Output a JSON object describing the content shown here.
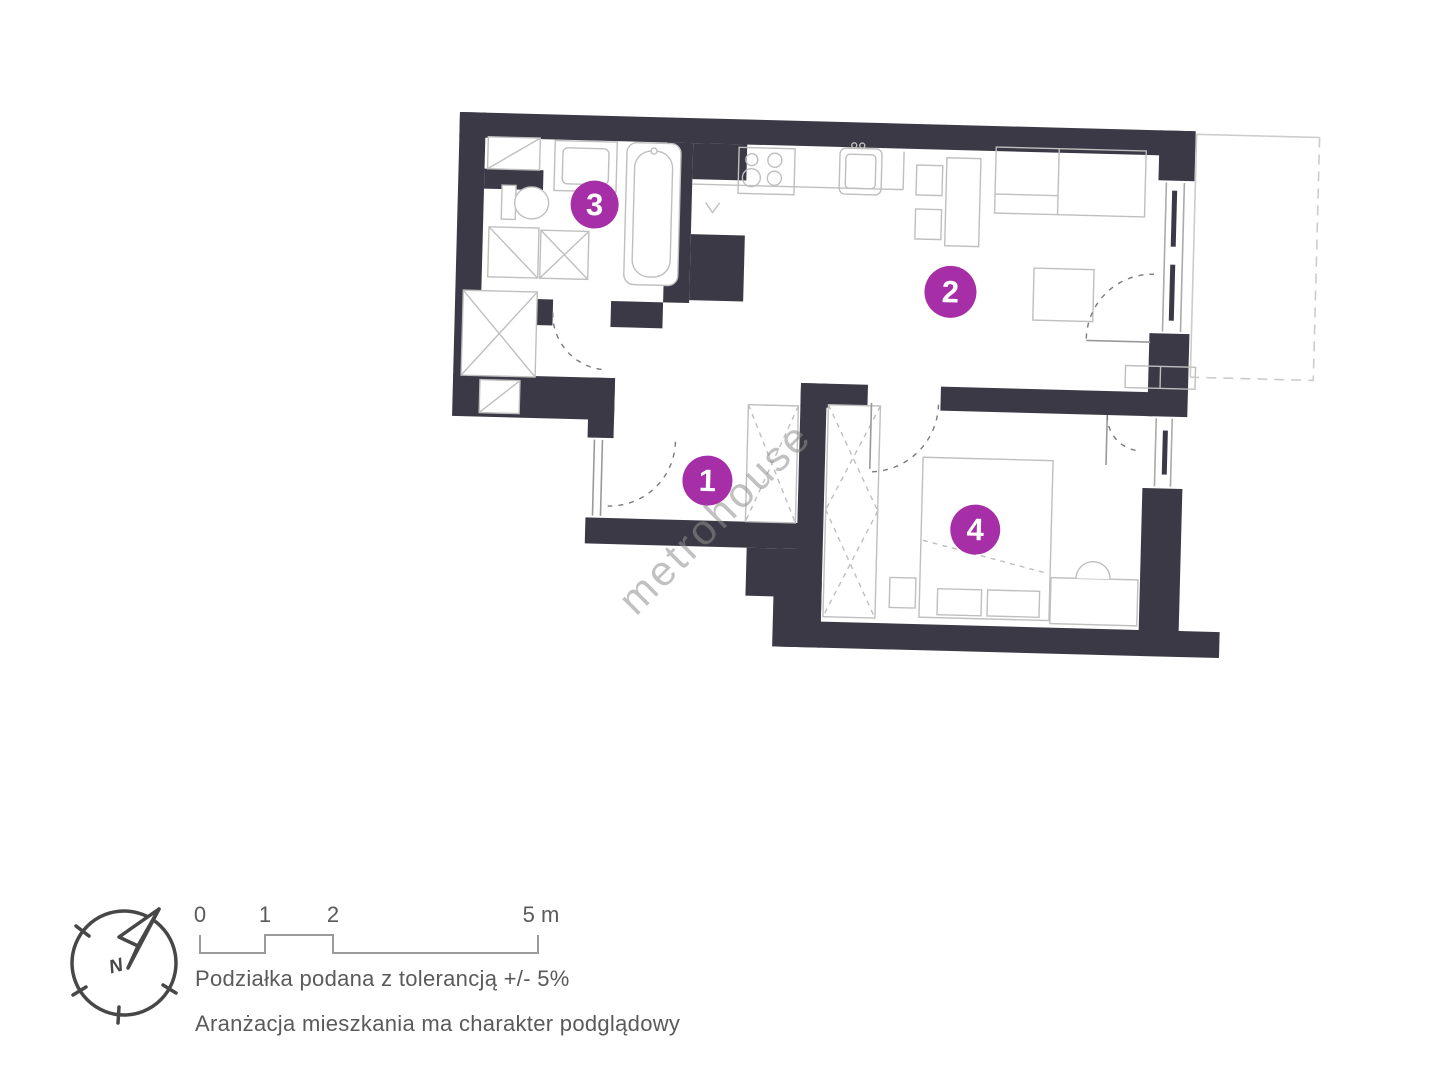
{
  "plan": {
    "watermark": "metrohouse",
    "markers": [
      {
        "label": "1"
      },
      {
        "label": "2"
      },
      {
        "label": "3"
      },
      {
        "label": "4"
      }
    ]
  },
  "legend": {
    "compass_north": "N",
    "scale_labels": [
      "0",
      "1",
      "2",
      "5 m"
    ],
    "tolerance_note": "Podziałka podana z tolerancją +/- 5%",
    "arrangement_note": "Aranżacja mieszkania ma charakter podglądowy"
  },
  "colors": {
    "wall": "#3B3945",
    "marker": "#A62FA8",
    "fixture_line": "#BFBFBF",
    "door_line": "#999999",
    "dash_line": "#7A7A7A",
    "balcony_line": "#CCCCCC",
    "legend_text": "#5A5A5A",
    "compass": "#474747",
    "watermark": "#8F8F8F"
  }
}
